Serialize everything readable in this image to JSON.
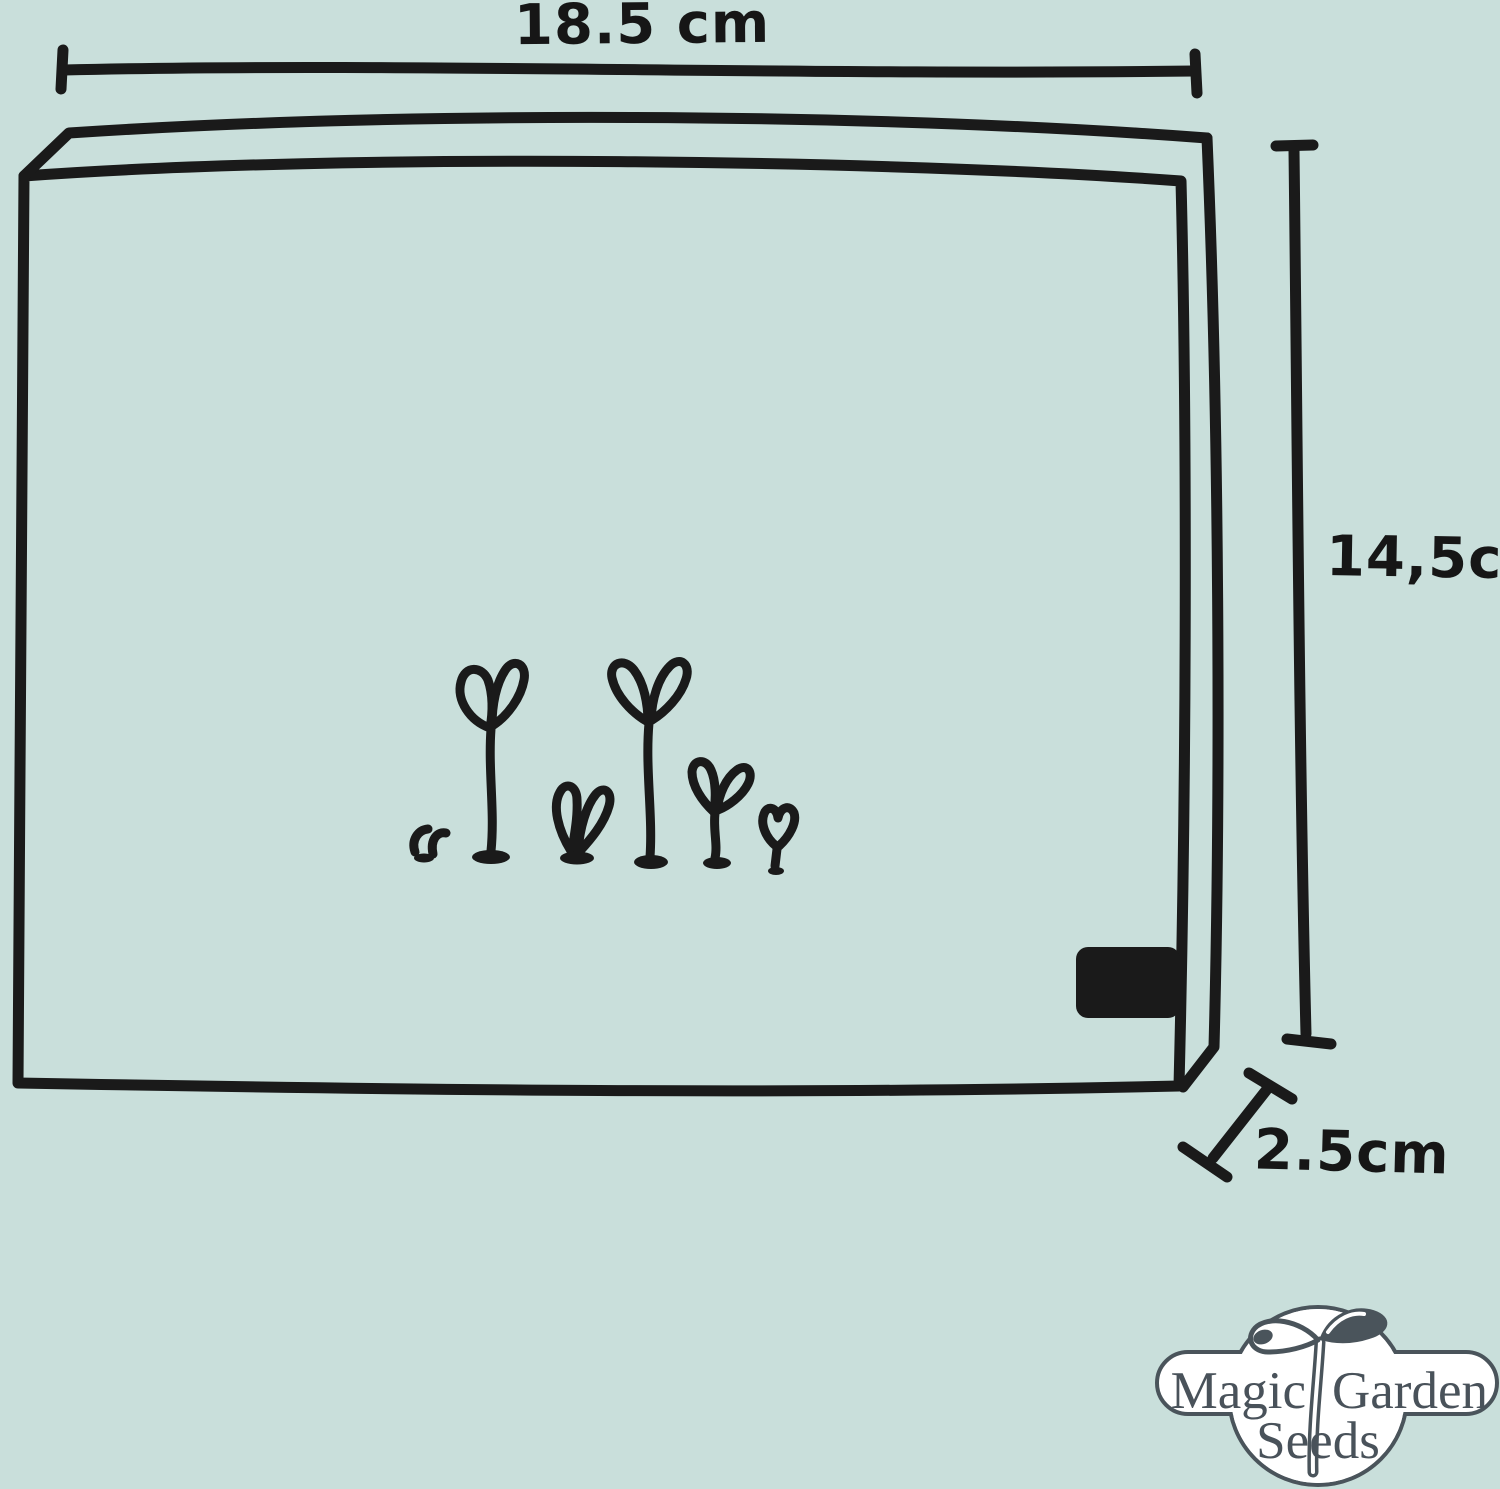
{
  "image": {
    "background_color": "#c9dfdb",
    "ink_color": "#1a1a1a",
    "subject": "hand-drawn seed packet with measurements"
  },
  "dimensions": {
    "width": {
      "label": "18.5 cm"
    },
    "height": {
      "label": "14,5cm"
    },
    "depth": {
      "label": "2.5cm"
    }
  },
  "drawing": {
    "icons": [
      "seed-packet-box",
      "sprout-doodles",
      "label-sticker"
    ],
    "sprout_count": 6
  },
  "logo": {
    "word_magic": "Magic",
    "word_garden": "Garden",
    "word_seeds": "Seeds",
    "outline_color": "#4a545b",
    "text_color": "#49525a",
    "fill_color": "#ffffff"
  }
}
